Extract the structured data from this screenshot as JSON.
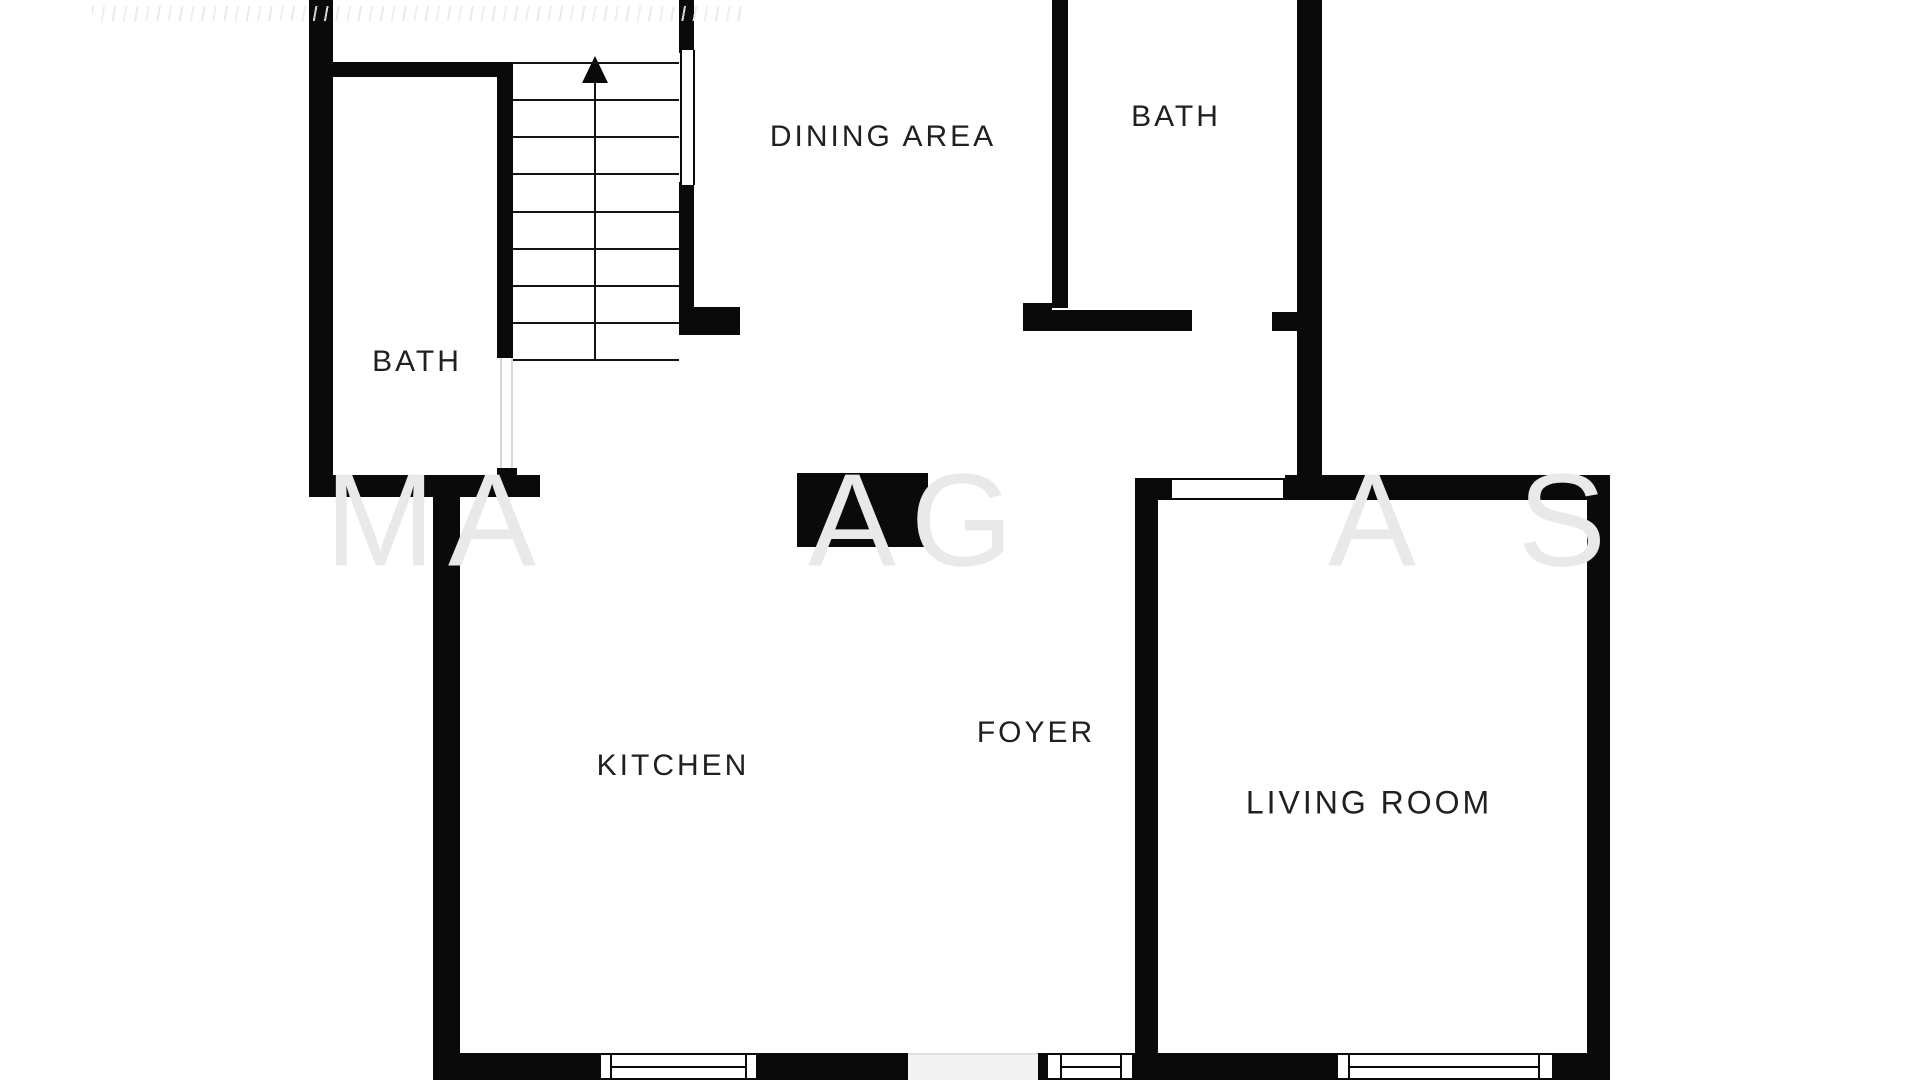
{
  "plan": {
    "title": "apartment floor plan",
    "style": "black-and-white architectural plan"
  },
  "rooms": [
    {
      "id": "dining-area",
      "label": "DINING AREA"
    },
    {
      "id": "bath-upper",
      "label": "BATH"
    },
    {
      "id": "bath-left",
      "label": "BATH"
    },
    {
      "id": "kitchen",
      "label": "KITCHEN"
    },
    {
      "id": "foyer",
      "label": "FOYER"
    },
    {
      "id": "living-room",
      "label": "LIVING ROOM"
    }
  ],
  "stairs": {
    "steps": 8,
    "arrow_direction": "up"
  },
  "watermark": {
    "letters": [
      {
        "ch": "M"
      },
      {
        "ch": "A"
      },
      {
        "ch": "A"
      },
      {
        "ch": "G"
      },
      {
        "ch": "A"
      },
      {
        "ch": "S"
      }
    ]
  },
  "colors": {
    "background": "#ffffff",
    "wall": "#0a0a0a",
    "label_text": "#202020",
    "watermark_light": "#e9e9e9",
    "watermark_on_wall": "#3a3a3a"
  }
}
